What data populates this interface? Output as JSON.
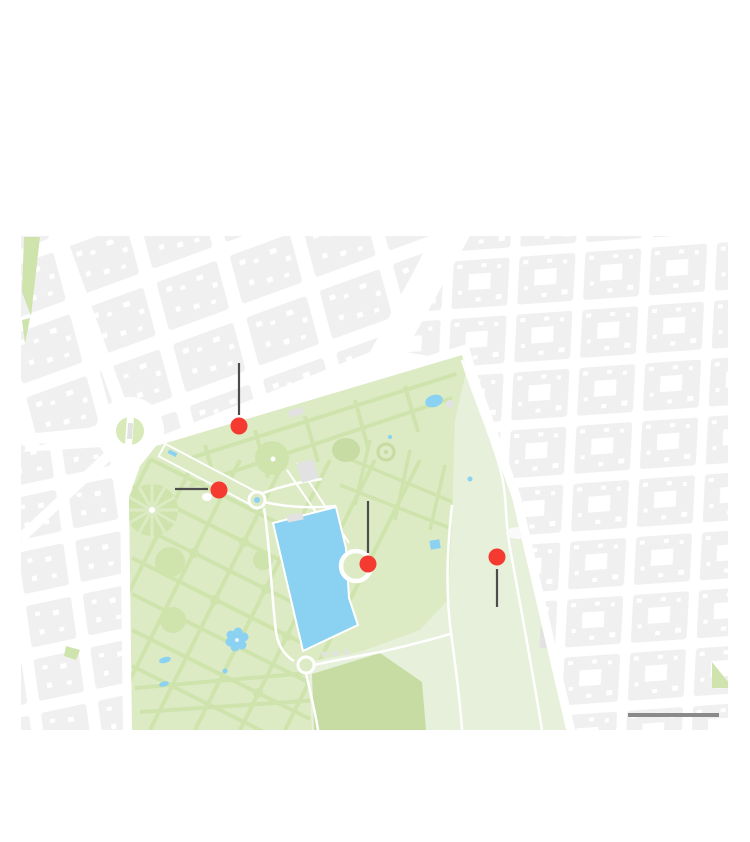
{
  "map": {
    "region": {
      "x": 21,
      "y": 236,
      "width": 707,
      "height": 494
    },
    "markers": [
      {
        "id": "marker-1",
        "x": 239,
        "y": 426
      },
      {
        "id": "marker-2",
        "x": 219,
        "y": 490
      },
      {
        "id": "marker-3",
        "x": 368,
        "y": 564
      },
      {
        "id": "marker-4",
        "x": 497,
        "y": 557
      }
    ],
    "marker_radius": 8.5,
    "leader_lines": [
      {
        "x1": 239,
        "y1": 363,
        "x2": 239,
        "y2": 415
      },
      {
        "x1": 175,
        "y1": 489,
        "x2": 208,
        "y2": 489
      },
      {
        "x1": 368,
        "y1": 501,
        "x2": 368,
        "y2": 553
      },
      {
        "x1": 497,
        "y1": 569,
        "x2": 497,
        "y2": 607
      }
    ],
    "leader_line_width": 2.2,
    "scale_bar": {
      "x1": 628,
      "x2": 719,
      "y": 715,
      "thickness": 4
    },
    "colors": {
      "street": "#ffffff",
      "block": "#f0f0f0",
      "park_base": "#dcebc4",
      "park_mid": "#cfe3ad",
      "park_dark": "#c6dca2",
      "park_pale": "#e7f0da",
      "water": "#8ad1f2",
      "building": "#e2e2e2",
      "marker": "#f43a31",
      "leader_line": "#4d4d4d",
      "scale_bar": "#8a8a8a"
    }
  }
}
